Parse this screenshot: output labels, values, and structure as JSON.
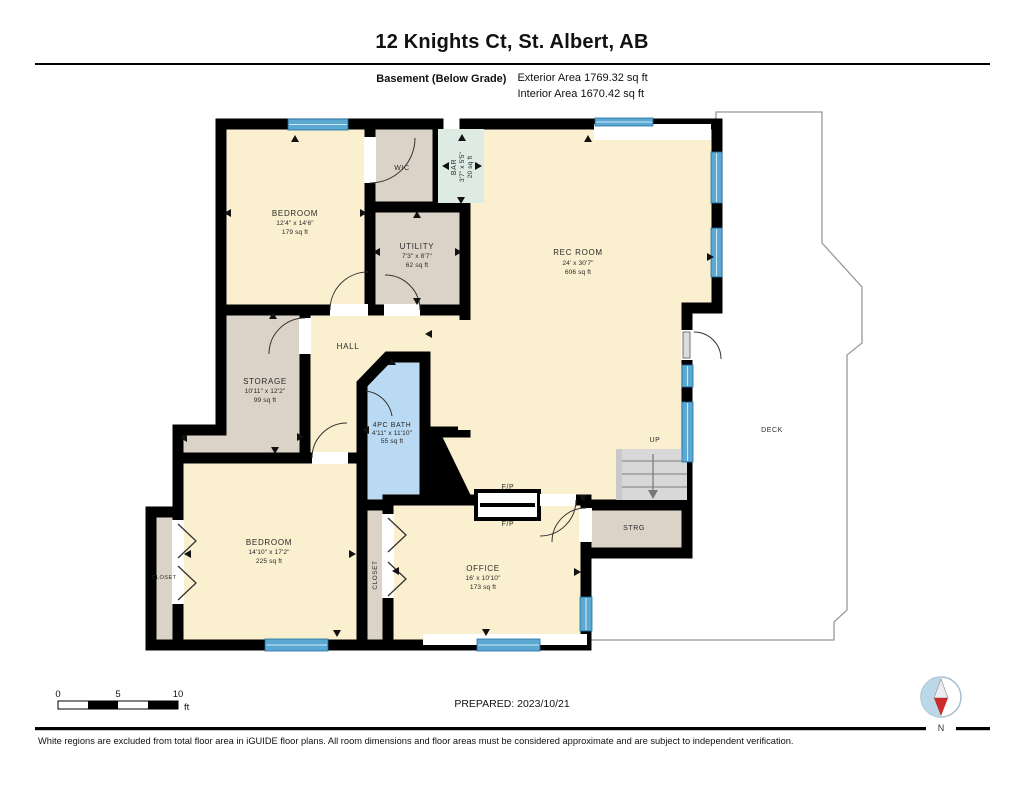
{
  "header": {
    "title": "12 Knights Ct, St. Albert, AB",
    "floor_label": "Basement (Below Grade)",
    "exterior_area": "Exterior Area 1769.32 sq ft",
    "interior_area": "Interior Area 1670.42 sq ft"
  },
  "rooms": {
    "bedroom1": {
      "name": "BEDROOM",
      "dims": "12'4\" x 14'6\"",
      "area": "179 sq ft"
    },
    "wic": {
      "name": "WIC"
    },
    "bar": {
      "name": "BAR",
      "dims": "3'7\" x 5'5\"",
      "area": "20 sq ft"
    },
    "utility": {
      "name": "UTILITY",
      "dims": "7'3\" x 8'7\"",
      "area": "62 sq ft"
    },
    "rec_room": {
      "name": "REC ROOM",
      "dims": "24' x 30'7\"",
      "area": "606 sq ft"
    },
    "hall": {
      "name": "HALL"
    },
    "storage": {
      "name": "STORAGE",
      "dims": "10'11\" x 12'2\"",
      "area": "99 sq ft"
    },
    "bath": {
      "name": "4PC BATH",
      "dims": "4'11\" x 11'10\"",
      "area": "55 sq ft"
    },
    "bedroom2": {
      "name": "BEDROOM",
      "dims": "14'10\" x 17'2\"",
      "area": "225 sq ft"
    },
    "closet_left": {
      "name": "CLOSET"
    },
    "closet_mid": {
      "name": "CLOSET"
    },
    "office": {
      "name": "OFFICE",
      "dims": "16' x 10'10\"",
      "area": "173 sq ft"
    },
    "strg": {
      "name": "STRG"
    },
    "stairs": {
      "name": "UP"
    },
    "deck": {
      "name": "DECK"
    },
    "fireplace": {
      "label": "F/P"
    }
  },
  "scale_bar": {
    "ticks": [
      "0",
      "5",
      "10"
    ],
    "unit": "ft"
  },
  "prepared_label": "PREPARED: 2023/10/21",
  "compass": {
    "north_label": "N"
  },
  "disclaimer": "White regions are excluded from total floor area in iGUIDE floor plans. All room dimensions and floor areas must be considered approximate and are subject to independent verification.",
  "colors": {
    "room_warm": "#FAEFCE",
    "room_tan": "#DBD3C7",
    "bath_blue": "#B9DAF2",
    "bar_teal": "#DEEBE4",
    "window_blue": "#5BA8D2",
    "stairs_gray": "#D8D8D8",
    "deck_outline": "#999999",
    "compass_blue": "#BBD8E8",
    "compass_red": "#CC2B2B"
  }
}
